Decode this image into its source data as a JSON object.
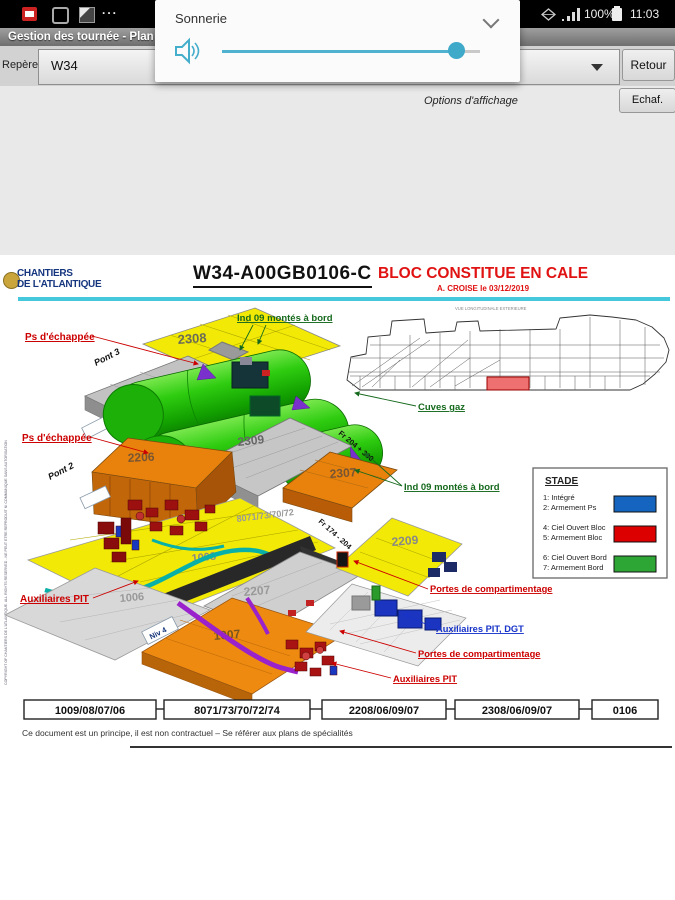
{
  "status_bar": {
    "time": "11:03",
    "battery_percent": "100%",
    "more_indicator": "...",
    "icons": {
      "left": [
        "app-notification-icon",
        "app-outline-icon",
        "screenshot-icon",
        "more-dots"
      ],
      "right": [
        "vpn-diamond-icon",
        "signal-bars-icon",
        "battery-icon"
      ]
    }
  },
  "title_bar": {
    "title": "Gestion des tournée - Plan"
  },
  "volume_popup": {
    "label": "Sonnerie",
    "volume_percent": 91,
    "accent_color": "#4fb3cf"
  },
  "toolbar": {
    "field_label": "Repère",
    "field_value": "W34",
    "back_button": "Retour",
    "display_options": "Options d'affichage",
    "scaffold_button": "Echaf."
  },
  "drawing": {
    "company": {
      "line1": "CHANTIERS",
      "line2": "DE L'ATLANTIQUE"
    },
    "doc_code": "W34-A00GB0106-C",
    "doc_title": "BLOC CONSTITUE EN CALE",
    "doc_author_date": "A. CROISE le 03/12/2019",
    "side_note": "COPYRIGHT OF CHANTIERS DE L'ATLANTIQUE. ALL RIGHTS RESERVED - NE PEUT ETRE REPRODUIT NI COMMUNIQUE SANS AUTORISATION",
    "profile_caption": "VUE LONGITUDINALE EXTERIEURE",
    "labels": {
      "ps_echappee_1": "Ps d'échappée",
      "ps_echappee_2": "Ps d'échappée",
      "ind09_1": "Ind 09 montés à bord",
      "ind09_2": "Ind 09 montés à bord",
      "cuves_gaz": "Cuves gaz",
      "portes_1": "Portes de compartimentage",
      "portes_2": "Portes de compartimentage",
      "aux_pit_dgt": "Auxiliaires PIT, DGT",
      "aux_pit_1": "Auxiliaires PIT",
      "aux_pit_2": "Auxiliaires PIT",
      "pont3": "Pont 3",
      "pont2": "Pont 2",
      "niv4": "Niv 4",
      "fr_204_300": "Fr 204 + 300",
      "fr_174_204": "Fr 174 - 204"
    },
    "blocks": {
      "b2308": "2308",
      "b2306": "2306",
      "b2309": "2309",
      "b2206": "2206",
      "b2307": "2307",
      "b1008": "1008",
      "b8071": "8071/73/70/72",
      "b8074": "8074",
      "b2207": "2207",
      "b2209": "2209",
      "b1006": "1006",
      "b1007": "1007"
    },
    "legend": {
      "title": "STADE",
      "entries": [
        {
          "line1": "1: Intégré",
          "line2": "2: Armement Ps",
          "color": "#1565c0"
        },
        {
          "line1": "4: Ciel Ouvert Bloc",
          "line2": "5: Armement Bloc",
          "color": "#dd0000"
        },
        {
          "line1": "6: Ciel Ouvert Bord",
          "line2": "7: Armement Bord",
          "color": "#2ea636"
        }
      ]
    },
    "bottom_codes": [
      "1009/08/07/06",
      "8071/73/70/72/74",
      "2208/06/09/07",
      "2308/06/09/07",
      "0106"
    ],
    "footer": "Ce document est un principe, il est  non contractuel – Se référer aux plans de spécialités"
  }
}
